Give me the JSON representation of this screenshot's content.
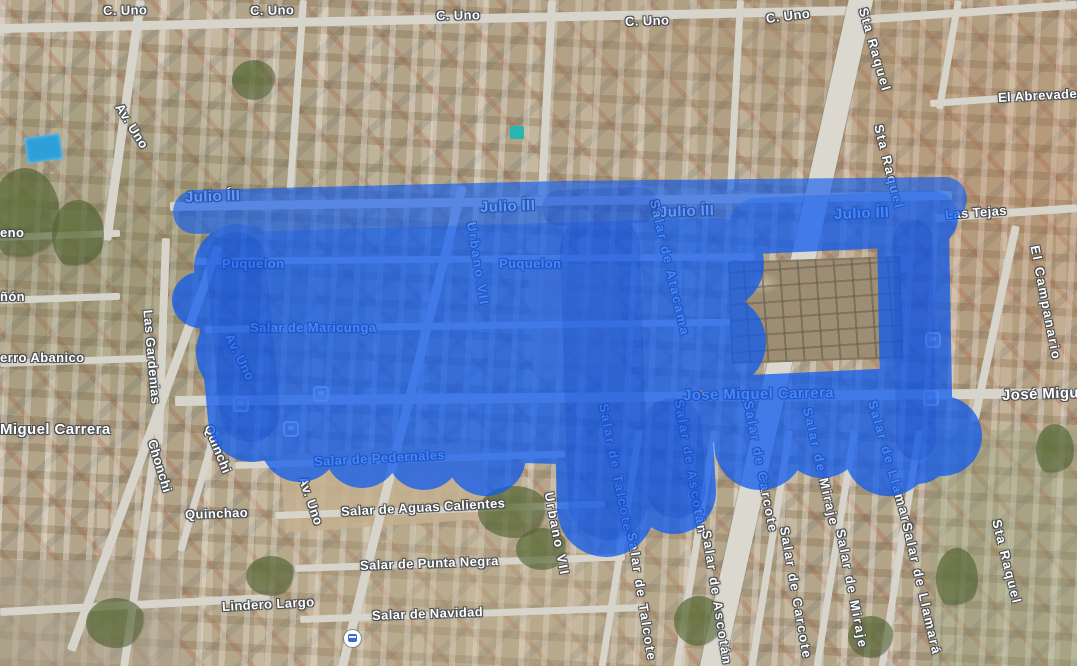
{
  "app": {
    "type": "satellite-map-view",
    "overlay_color": "#0d5af0",
    "overlay_shadow_color": "#0030b8",
    "label_color": "#ffffff"
  },
  "icons": {
    "transit_station": "transit-station-icon",
    "bus_stop": "bus-stop-icon"
  },
  "labels": {
    "c_uno_1": "C. Uno",
    "c_uno_2": "C. Uno",
    "c_uno_3": "C. Uno",
    "c_uno_4": "C. Uno",
    "c_uno_5": "C. Uno",
    "av_uno_tl": "Av. Uno",
    "sta_raquel_1": "Sta Raquel",
    "sta_raquel_2": "Sta Raquel",
    "sta_raquel_3": "Sta Raquel",
    "el_abrevadero": "El Abrevadero",
    "las_tejas": "Las Tejas",
    "el_campanario": "El Campanario",
    "jose_miguel_r": "José Migue",
    "eno": "eno",
    "non": "ñón",
    "erro_abanico": "erro Abanico",
    "miguel_carrera": "Miguel Carrera",
    "las_gardenias": "Las Gardenias",
    "chonchi": "Chonchi",
    "quinchi": "Quinchi",
    "quinchao": "Quinchao",
    "salar_pedernales": "Salar de Pedernales",
    "av_uno_low": "Av. Uno",
    "salar_aguas": "Salar de Aguas Calientes",
    "salar_punta": "Salar de Punta Negra",
    "urbano_vii_low": "Urbano VII",
    "lindero_largo": "Lindero Largo",
    "salar_navidad": "Salar de Navidad",
    "julio_1": "Julio ÍII",
    "julio_2": "Julio ÍII",
    "julio_3": "Julio ÍII",
    "julio_4": "Julio ÍII",
    "puquelon_1": "Puquelon",
    "puquelon_2": "Puquelon",
    "salar_maricunga": "Salar de Maricunga",
    "av_uno_mid": "Av. Uno",
    "urbano_vii_top": "Urbano VII",
    "salar_atacama": "Salar de Atacama",
    "jose_miguel_c": "Jose Miguel Carrera",
    "talcote_1": "Salar de Talcote",
    "talcote_2": "Salar de Talcote",
    "ascotan_1": "Salar de Ascotán",
    "ascotan_2": "Salar de Ascotán",
    "carcote_1": "Salar de Carcote",
    "carcote_2": "Salar de Carcote",
    "miraje_1": "Salar de Miraje",
    "miraje_2": "Salar de Miraje",
    "llamara_1": "Salar de Llamará",
    "llamara_2": "Salar de Llamará"
  }
}
